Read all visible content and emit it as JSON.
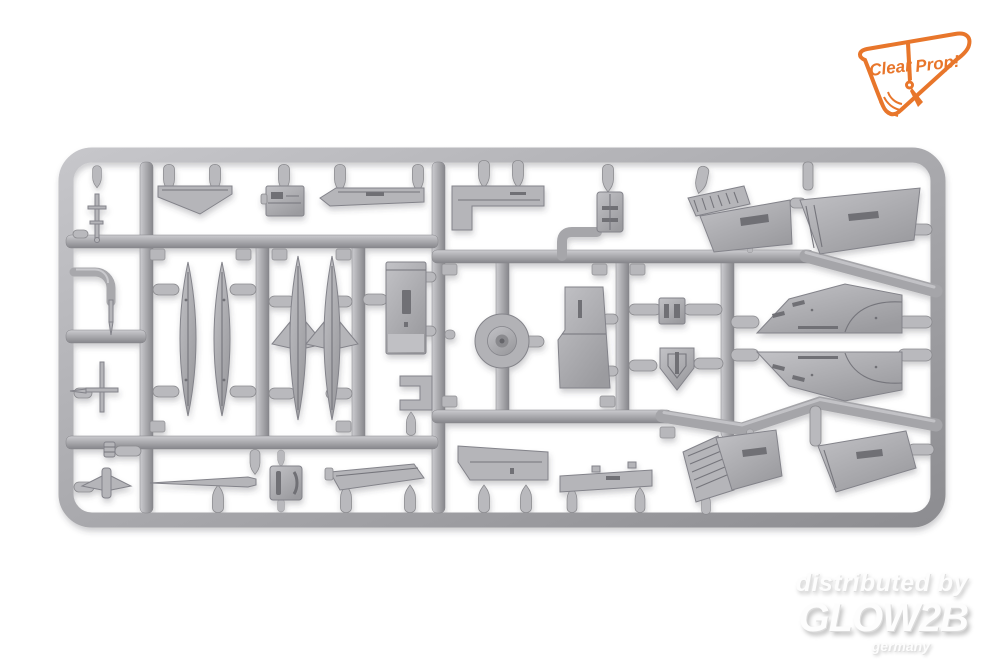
{
  "photo": {
    "background_color": "#ffffff",
    "sprue": {
      "plastic_color": "#a9a9ad",
      "highlight_color": "#ccccd0",
      "shadow_color": "#86868b",
      "parts": [
        "drop-tank-halves",
        "finned-tank-halves",
        "delta-wing-upper-half",
        "delta-wing-lower-half",
        "wing-panels",
        "flap-sections",
        "avionics-box",
        "wheel-disc",
        "tail-fin",
        "intake-cone",
        "canopy-clamp",
        "pitot-probe",
        "bent-pipe",
        "antenna-linkage",
        "small-detail-parts"
      ]
    }
  },
  "logo": {
    "word1": "Clear",
    "word2": "Prop!",
    "color": "#e8762b",
    "icon": "propeller-icon"
  },
  "watermark": {
    "line1": "distributed by",
    "line2": "GLOW2B",
    "line3": "germany",
    "color": "#f5f5f5"
  }
}
